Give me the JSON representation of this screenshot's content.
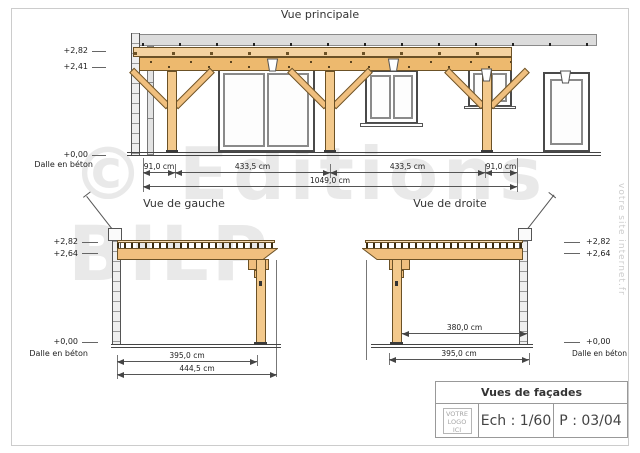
{
  "page": {
    "title_main": "Vue principale",
    "title_left": "Vue de gauche",
    "title_right": "Vue de droite",
    "watermark_line1": "© Editions",
    "watermark_line2": "BILP",
    "side_text": "votre site internet.fr"
  },
  "main_view": {
    "levels": [
      "+2,82",
      "+2,41",
      "+0,00"
    ],
    "slab_label": "Dalle en béton",
    "dims_row1": [
      "91,0 cm",
      "433,5 cm",
      "433,5 cm",
      "91,0 cm"
    ],
    "dim_total": "1049,0 cm"
  },
  "left_view": {
    "levels": [
      "+2,82",
      "+2,64",
      "+0,00"
    ],
    "slab_label": "Dalle en béton",
    "dim_inner": "395,0 cm",
    "dim_outer": "444,5 cm"
  },
  "right_view": {
    "levels": [
      "+2,82",
      "+2,64",
      "+0,00"
    ],
    "slab_label": "Dalle en béton",
    "dim_depth": "380,0 cm",
    "dim_bottom": "395,0 cm"
  },
  "title_block": {
    "title": "Vues de façades",
    "logo_lines": [
      "VOTRE",
      "LOGO",
      "ICI"
    ],
    "scale": "Ech : 1/60",
    "page_num": "P : 03/04"
  }
}
